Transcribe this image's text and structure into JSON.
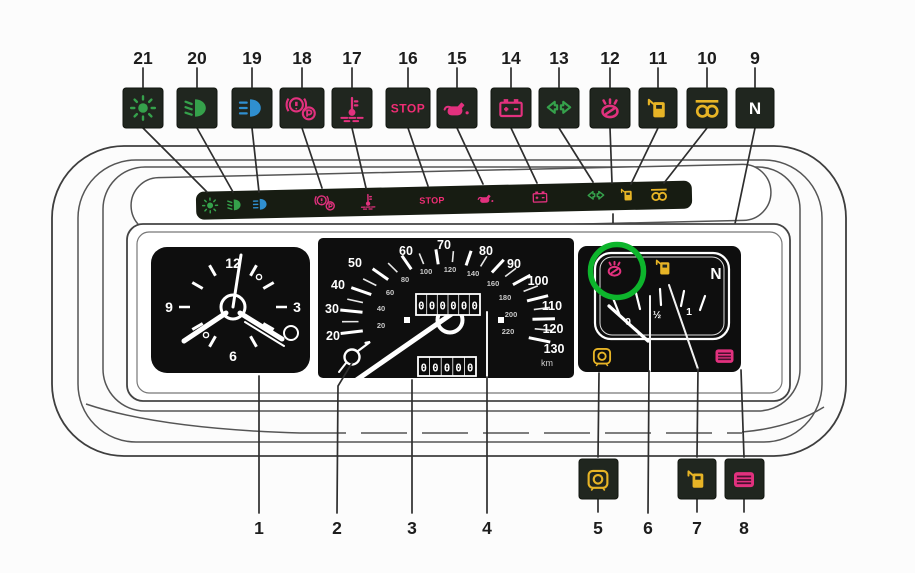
{
  "legend_top": {
    "items": [
      {
        "number": "21",
        "icon": "side-lights-icon",
        "color": "#35a14b"
      },
      {
        "number": "20",
        "icon": "dipped-beam-icon",
        "color": "#35a14b"
      },
      {
        "number": "19",
        "icon": "main-beam-icon",
        "color": "#2f8fd0"
      },
      {
        "number": "18",
        "icon": "brake-warning-icon",
        "color": "#e2317e"
      },
      {
        "number": "17",
        "icon": "coolant-temperature-icon",
        "color": "#e2317e"
      },
      {
        "number": "16",
        "icon": "stop-warning",
        "color": "#ef2d74",
        "label": "STOP"
      },
      {
        "number": "15",
        "icon": "oil-pressure-icon",
        "color": "#e2317e"
      },
      {
        "number": "14",
        "icon": "battery-charge-icon",
        "color": "#e2317e"
      },
      {
        "number": "13",
        "icon": "direction-indicators-icon",
        "color": "#35a14b"
      },
      {
        "number": "12",
        "icon": "choke-icon",
        "color": "#e2317e"
      },
      {
        "number": "11",
        "icon": "fuel-pump-icon",
        "color": "#e7b426"
      },
      {
        "number": "10",
        "icon": "glow-plugs-icon",
        "color": "#e7b426"
      },
      {
        "number": "9",
        "icon": "neutral-indicator",
        "color": "#d9cd8d",
        "label": "N"
      }
    ]
  },
  "legend_bottom": {
    "items": [
      {
        "number": "1"
      },
      {
        "number": "2"
      },
      {
        "number": "3"
      },
      {
        "number": "4"
      },
      {
        "number": "5",
        "icon": "bulb-check-icon",
        "color": "#e7b426"
      },
      {
        "number": "6"
      },
      {
        "number": "7",
        "icon": "fuel-pump-icon",
        "color": "#e7b426"
      },
      {
        "number": "8",
        "icon": "heated-rear-window-icon",
        "color": "#e2317e"
      }
    ]
  },
  "cluster_strip": {
    "icons": [
      {
        "icon": "side-lights-icon",
        "color": "#35a14b"
      },
      {
        "icon": "dipped-beam-icon",
        "color": "#35a14b"
      },
      {
        "icon": "main-beam-icon",
        "color": "#2f8fd0"
      },
      {
        "icon": "brake-warning-icon",
        "color": "#e2317e"
      },
      {
        "icon": "coolant-temperature-icon",
        "color": "#e2317e"
      },
      {
        "icon": "stop-warning",
        "color": "#ef2d74"
      },
      {
        "icon": "oil-pressure-icon",
        "color": "#e2317e"
      },
      {
        "icon": "battery-charge-icon",
        "color": "#e2317e"
      },
      {
        "icon": "direction-indicators-icon",
        "color": "#35a14b"
      },
      {
        "icon": "fuel-pump-icon",
        "color": "#e7b426"
      },
      {
        "icon": "glow-plugs-icon",
        "color": "#e7b426"
      }
    ]
  },
  "clock": {
    "numerals": {
      "top": "12",
      "right": "3",
      "bottom": "6",
      "left": "9"
    }
  },
  "speedometer": {
    "mph_labels": [
      "20",
      "30",
      "40",
      "50",
      "60",
      "70",
      "80",
      "90",
      "100",
      "110",
      "120",
      "130"
    ],
    "kmh_labels": [
      "20",
      "40",
      "60",
      "80",
      "100",
      "120",
      "140",
      "160",
      "180",
      "200",
      "220"
    ],
    "odometer_digits": [
      "0",
      "0",
      "0",
      "0",
      "0",
      "0"
    ],
    "trip_digits": [
      "0",
      "0",
      "0",
      "0",
      "0"
    ],
    "unit": "km"
  },
  "fuel_gauge": {
    "empty": "0",
    "half": "½",
    "full": "1",
    "neutral": "N"
  },
  "annotation": {
    "highlight_color": "#0db52c"
  }
}
